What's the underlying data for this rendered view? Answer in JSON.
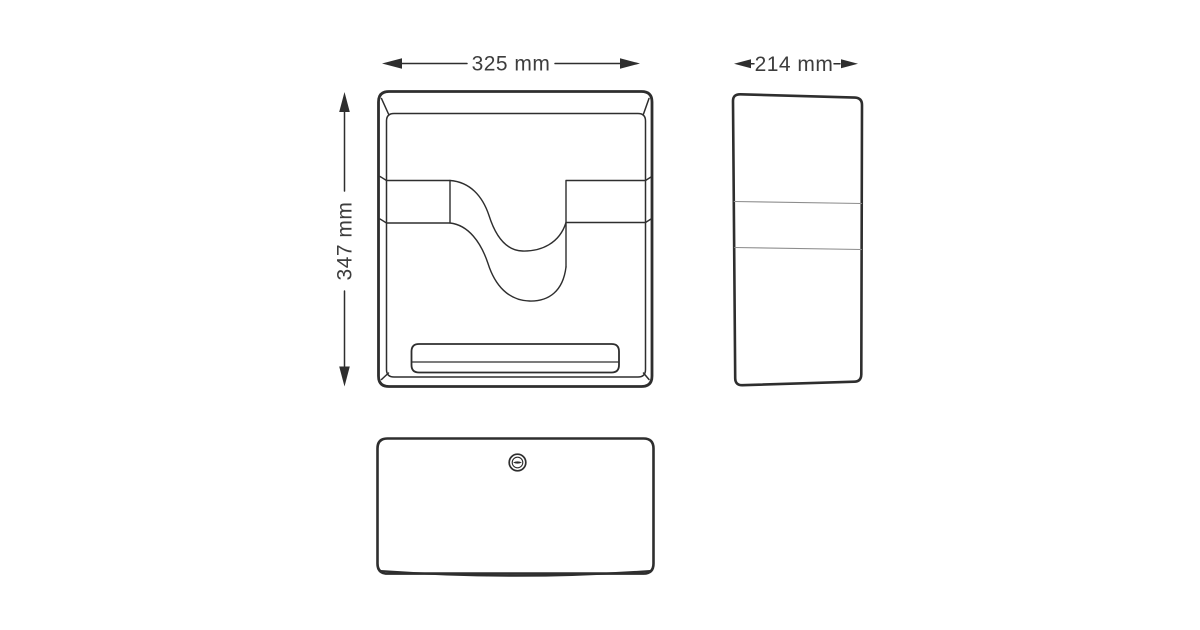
{
  "drawing": {
    "background": "#ffffff",
    "line_color": "#2e2e2e",
    "thin_line_color": "#8d8d8d",
    "label_color": "#3d3d3d",
    "labels": {
      "width": "325 mm",
      "depth": "214 mm",
      "height": "347 mm"
    },
    "views": {
      "front": "front view of dispenser with wave paper window and bottom slot",
      "side": "side profile view",
      "top": "top lid view with keyhole lock"
    },
    "icons": {
      "lock": "keyhole-lock-icon"
    }
  }
}
